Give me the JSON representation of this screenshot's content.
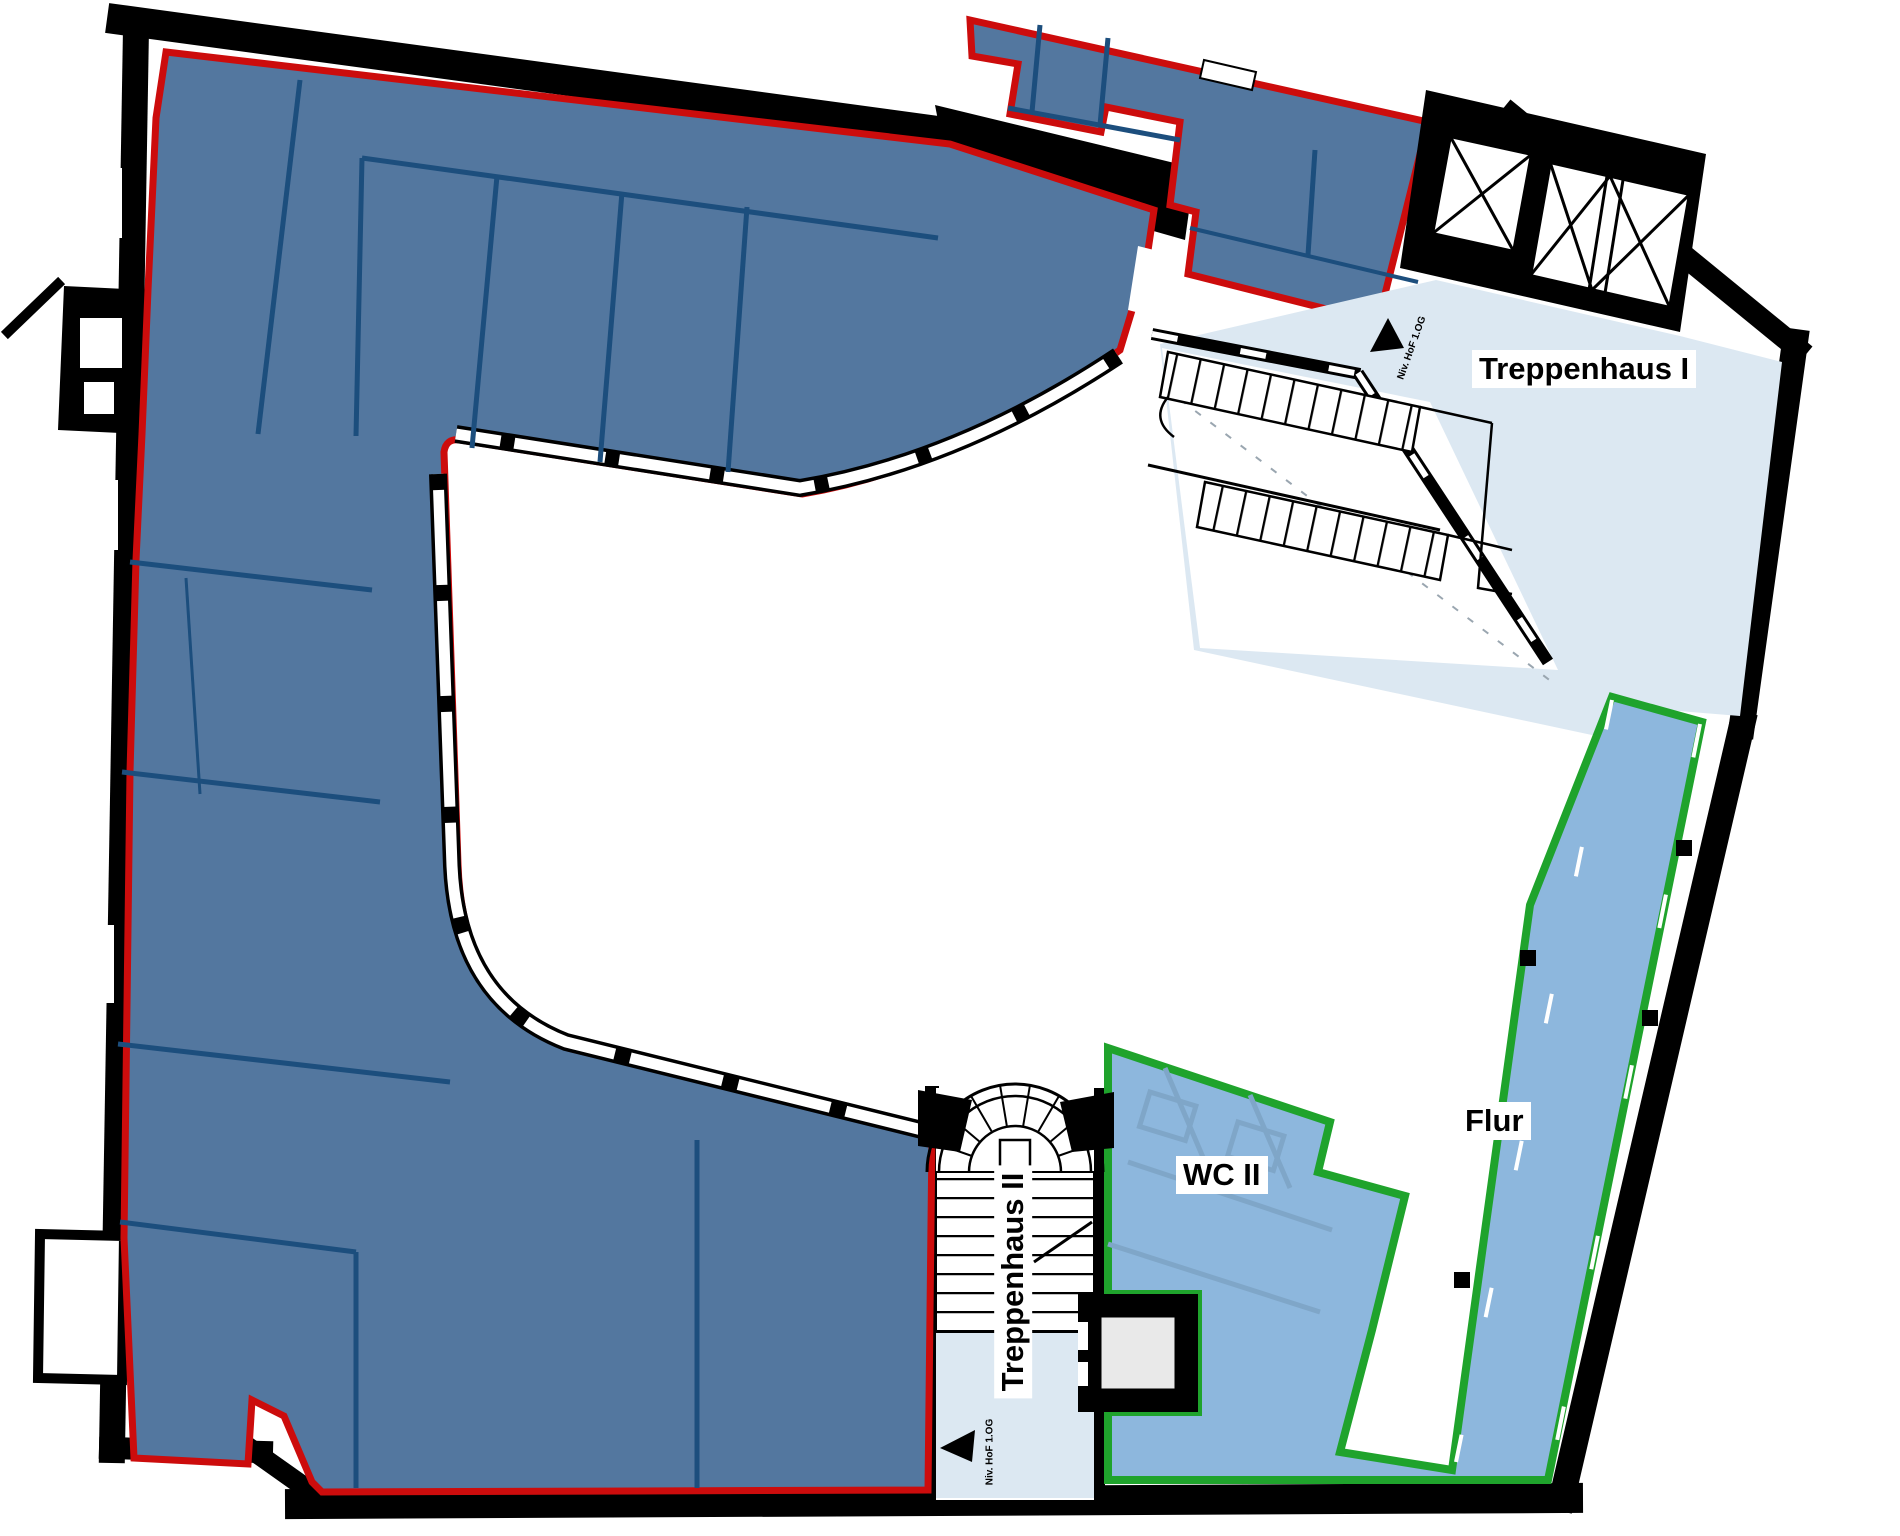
{
  "labels": {
    "treppenhaus1": "Treppenhaus I",
    "treppenhaus2": "Treppenhaus II",
    "wc2": "WC II",
    "flur": "Flur"
  },
  "markers": {
    "level1": "Niv. HoF 1.OG",
    "level2": "Niv. HoF 1.OG"
  },
  "legend": {
    "main_area_fill": "#53779f",
    "main_area_outline": "#cc0c0c",
    "corridor_area_fill": "#8db7dd",
    "corridor_area_outline": "#1fa32c",
    "stairwell_fill": "#dce8f2",
    "partition_color": "#1c4e7d",
    "partition_muted": "#7fa6c8",
    "wall_color": "#000000",
    "elevator_fill": "#e9e9e9",
    "background": "#ffffff"
  }
}
